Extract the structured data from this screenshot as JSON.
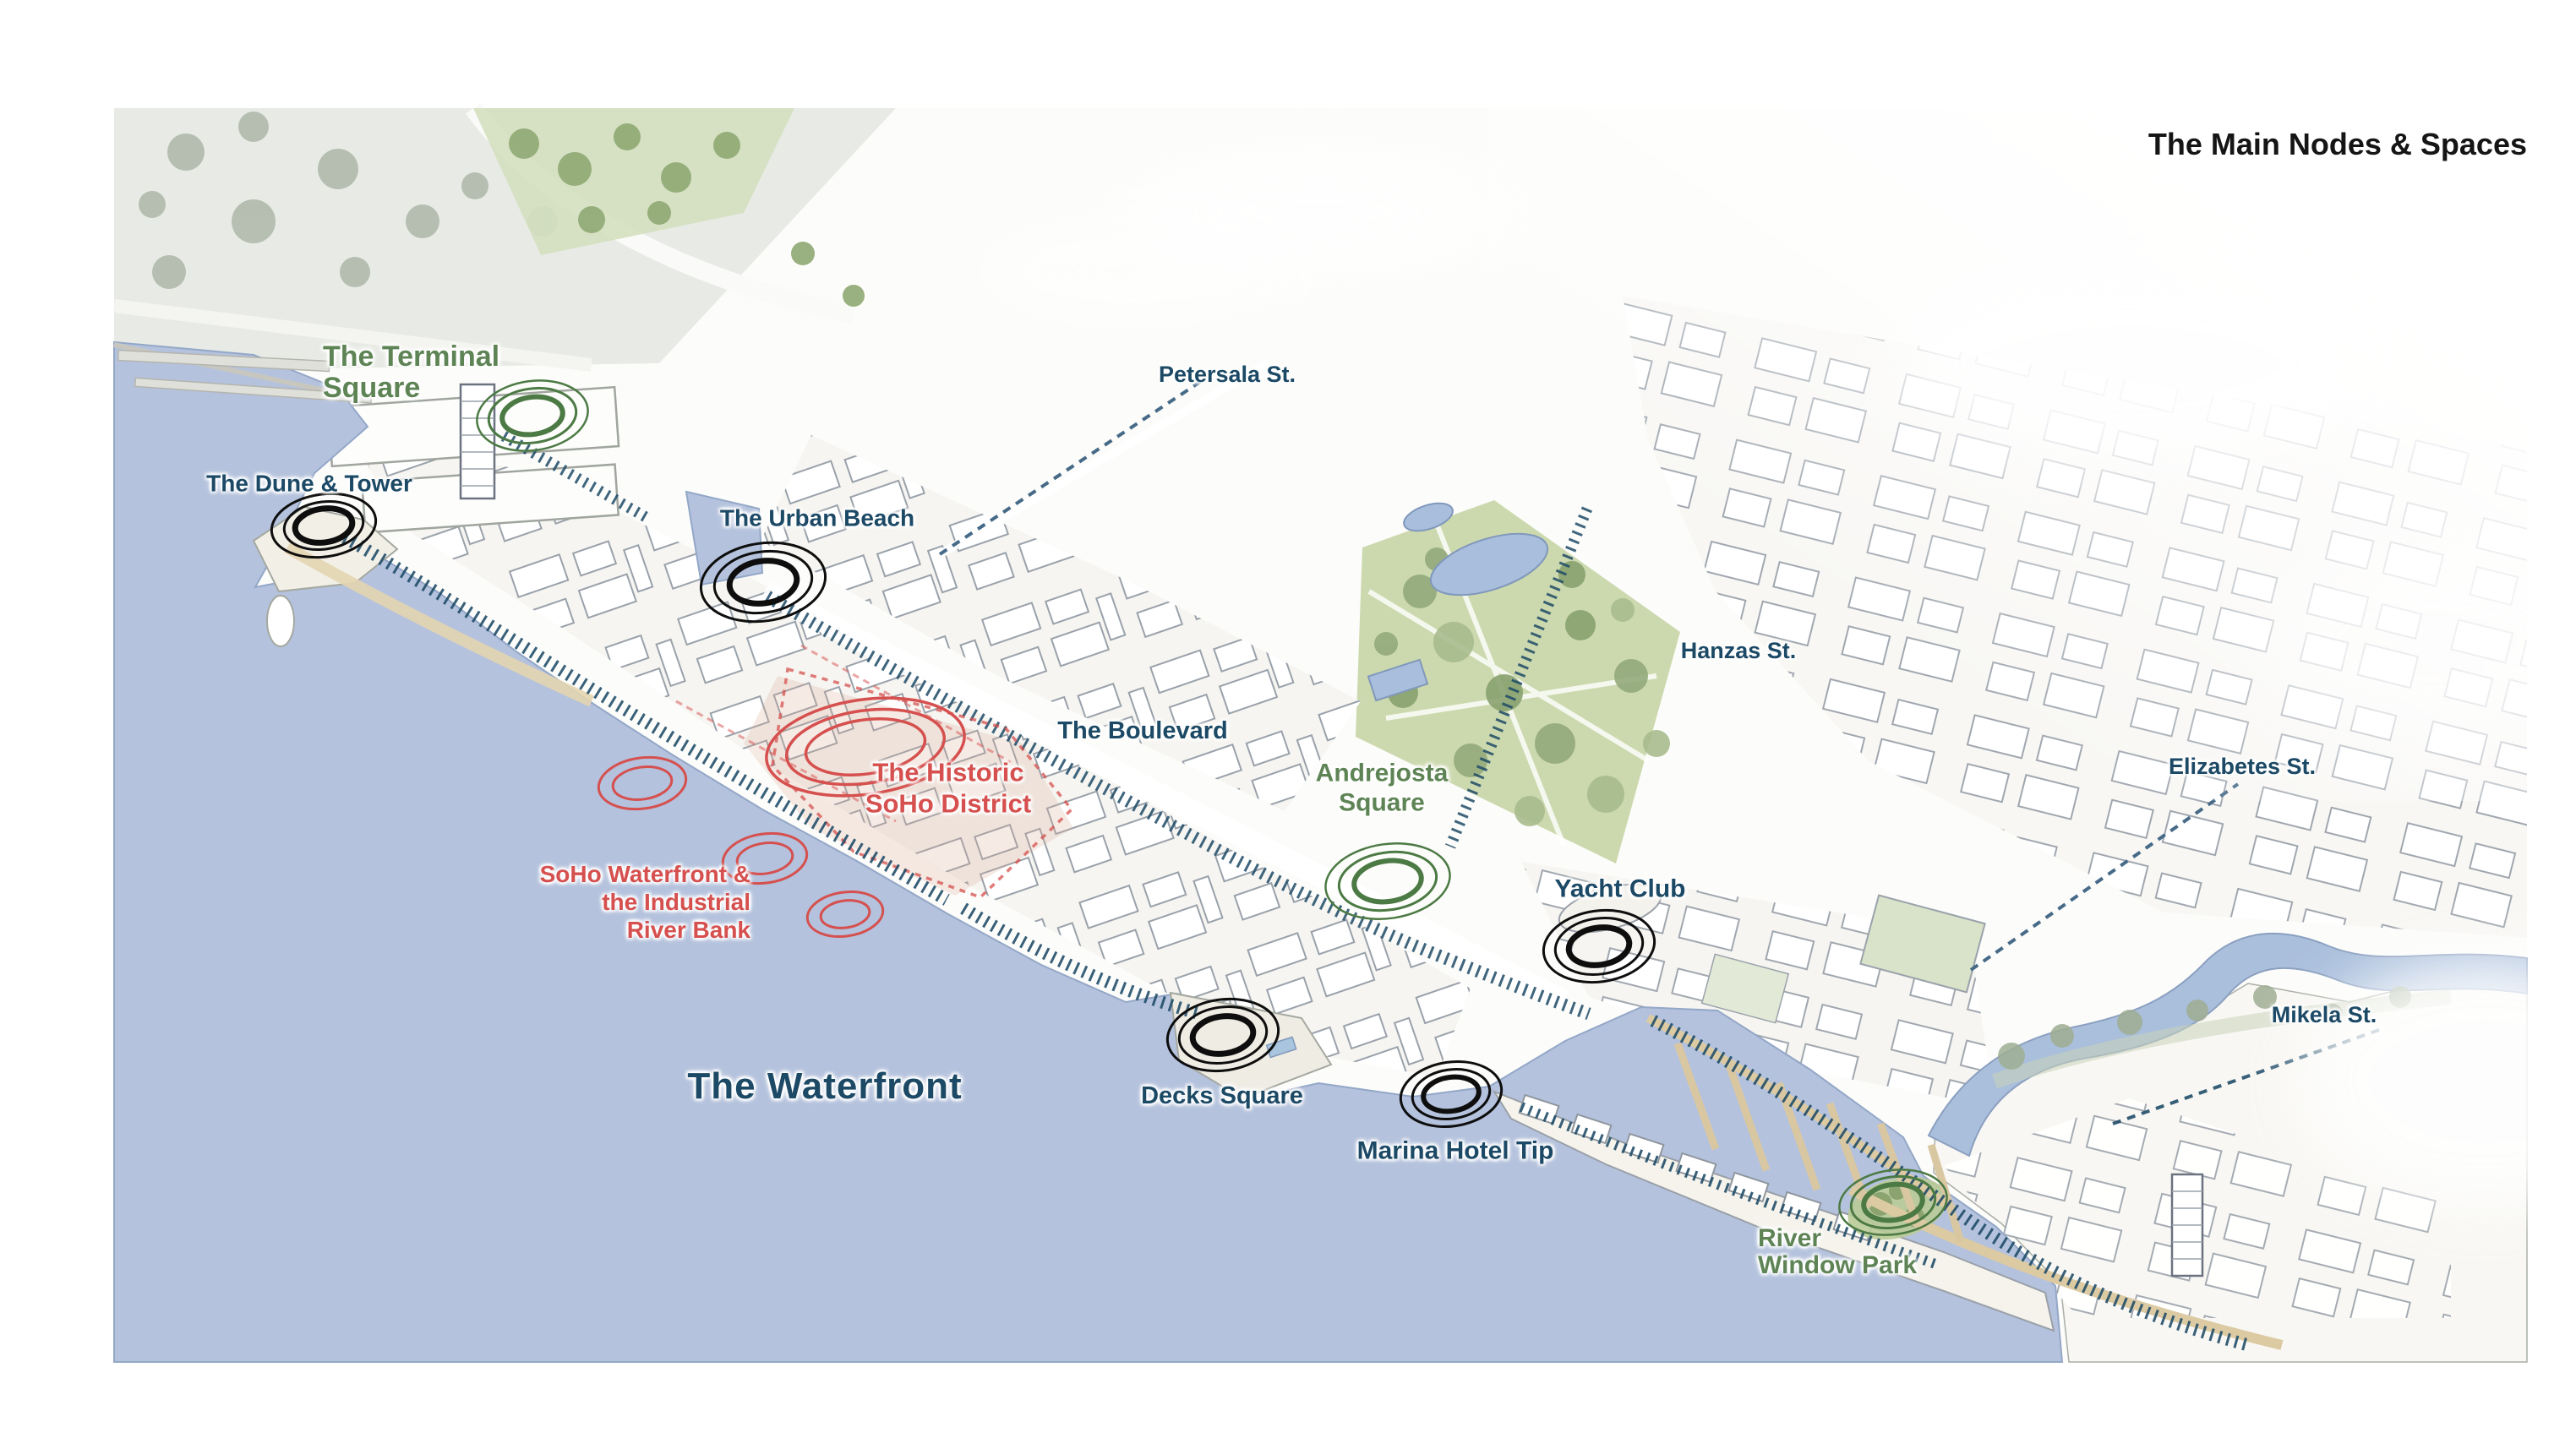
{
  "title": "The Main Nodes & Spaces",
  "map": {
    "nodes": [
      {
        "label": "The Terminal\nSquare",
        "marker": "green",
        "category": "public-space"
      },
      {
        "label": "The Dune & Tower",
        "marker": "black",
        "category": "landmark"
      },
      {
        "label": "The Urban Beach",
        "marker": "black",
        "category": "public-space"
      },
      {
        "label": "Andrejosta\nSquare",
        "marker": "green",
        "category": "public-space"
      },
      {
        "label": "Yacht Club",
        "marker": "black",
        "category": "landmark"
      },
      {
        "label": "Decks Square",
        "marker": "black",
        "category": "public-space"
      },
      {
        "label": "Marina Hotel Tip",
        "marker": "black",
        "category": "landmark"
      },
      {
        "label": "River\nWindow Park",
        "marker": "green",
        "category": "park"
      }
    ],
    "areas": [
      {
        "label": "The Historic\nSoHo District",
        "color": "red"
      },
      {
        "label": "SoHo Waterfront &\nthe Industrial\nRiver Bank",
        "color": "red"
      },
      {
        "label": "The Boulevard",
        "color": "navy"
      },
      {
        "label": "The Waterfront",
        "color": "navy"
      }
    ],
    "streets": [
      {
        "label": "Petersala St."
      },
      {
        "label": "Hanzas St."
      },
      {
        "label": "Elizabetes St."
      },
      {
        "label": "Mikela St."
      }
    ],
    "colors": {
      "water": "#b4c2dd",
      "marker_black": "#0e0e0e",
      "marker_green": "#4c7a44",
      "marker_red": "#d5504e",
      "label_navy": "#1c4965",
      "label_green": "#5e8455",
      "label_red": "#d5504e",
      "park_green": "#ccd9ae",
      "sand": "#dccaa3"
    }
  }
}
